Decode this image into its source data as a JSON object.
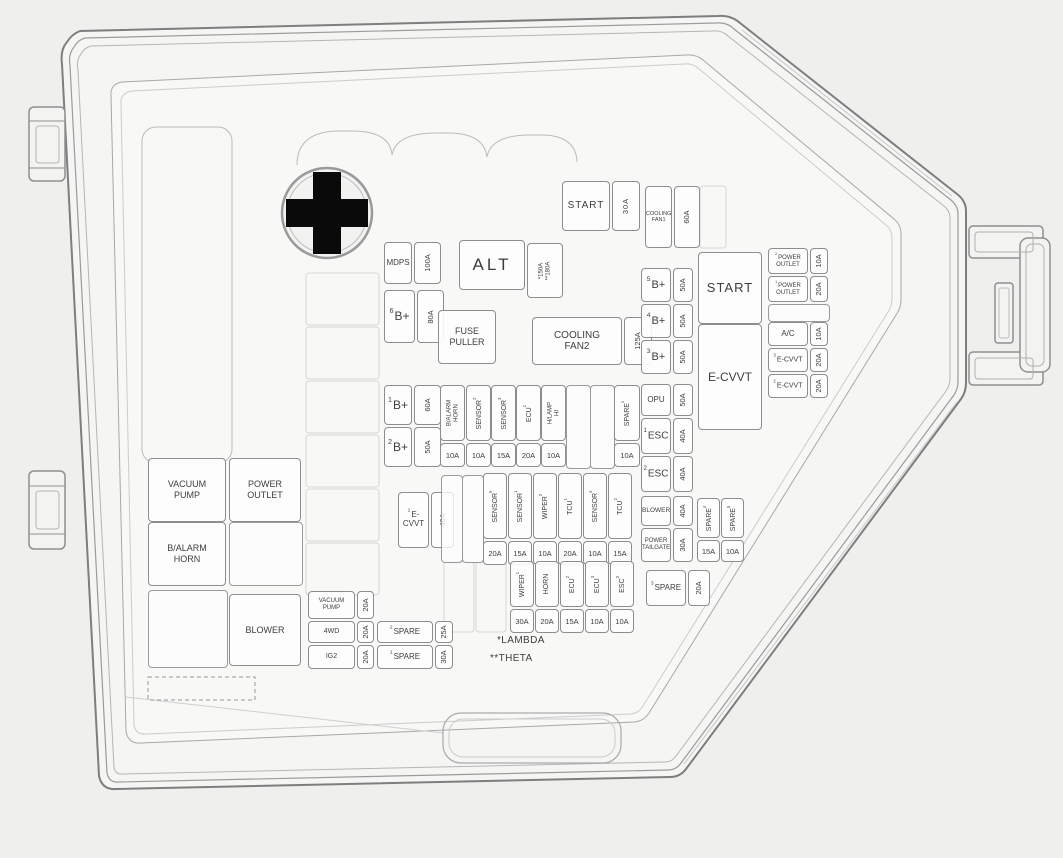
{
  "diagram_title": "Engine compartment fuse box cover diagram",
  "colors": {
    "line": "#8d8d8d",
    "text": "#3e3e3e",
    "background": "#efefee",
    "battery_symbol": "#0a0a0a"
  },
  "notes_legend": {
    "lambda": "*LAMBDA",
    "theta": "**THETA"
  },
  "items": [
    {
      "name": "fuse-start-top",
      "type": "h",
      "label": "START",
      "value": "30A",
      "x": 562,
      "y": 181,
      "w": 78,
      "h": 50,
      "vw": 26,
      "fs": 10,
      "ls": 1
    },
    {
      "name": "fuse-cooling-fan1",
      "type": "h",
      "label": "COOLING",
      "label2": "FAN1",
      "value": "60A",
      "x": 645,
      "y": 186,
      "w": 53,
      "h": 62,
      "vw": 24,
      "fs": 5.5
    },
    {
      "name": "fuse-mdps",
      "type": "h",
      "label": "MDPS",
      "value": "100A",
      "x": 384,
      "y": 242,
      "w": 57,
      "h": 42,
      "vw": 25,
      "fs": 8
    },
    {
      "name": "fuse-b-plus-6",
      "type": "h",
      "sup": "6",
      "label": "B+",
      "value": "80A",
      "x": 384,
      "y": 290,
      "w": 60,
      "h": 53,
      "vw": 25,
      "fs": 12
    },
    {
      "name": "alt-label-box",
      "type": "box",
      "label": "ALT",
      "x": 459,
      "y": 240,
      "w": 66,
      "h": 48,
      "fs": 17,
      "ls": 3
    },
    {
      "name": "fuse-alt",
      "type": "h",
      "label": "",
      "value": "*150A",
      "value2": "**180A",
      "x": 527,
      "y": 243,
      "w": 34,
      "h": 55,
      "vw": 34,
      "vfs": 6
    },
    {
      "name": "fuse-puller-box",
      "type": "box",
      "label": "FUSE",
      "label2": "PULLER",
      "x": 438,
      "y": 310,
      "w": 58,
      "h": 52,
      "fs": 9
    },
    {
      "name": "fuse-b-plus-1",
      "type": "h",
      "sup": "1",
      "label": "B+",
      "value": "60A",
      "x": 384,
      "y": 385,
      "w": 57,
      "h": 40,
      "vw": 25,
      "fs": 12
    },
    {
      "name": "fuse-b-plus-2",
      "type": "h",
      "sup": "2",
      "label": "B+",
      "value": "50A",
      "x": 384,
      "y": 427,
      "w": 57,
      "h": 40,
      "vw": 25,
      "fs": 12
    },
    {
      "name": "fuse-cooling-fan2",
      "type": "h",
      "label": "COOLING",
      "label2": "FAN2",
      "value": "125A",
      "x": 532,
      "y": 317,
      "w": 120,
      "h": 48,
      "vw": 26,
      "fs": 10
    },
    {
      "name": "fuse-e-cvvt-1",
      "type": "h",
      "sup": "1",
      "label": "E-",
      "label2": "CVVT",
      "value": "40A",
      "x": 398,
      "y": 492,
      "w": 56,
      "h": 56,
      "vw": 21,
      "fs": 8
    },
    {
      "name": "fuse-b-alarm-horn",
      "type": "v",
      "label": "B/ALARM",
      "label2": "HORN",
      "value": "10A",
      "x": 440,
      "y": 385,
      "w": 25,
      "h": 82,
      "fs": 6
    },
    {
      "name": "fuse-sensor-2",
      "type": "v",
      "label": "SENSOR",
      "sup": "2",
      "value": "10A",
      "x": 466,
      "y": 385,
      "w": 25,
      "h": 82,
      "fs": 7
    },
    {
      "name": "fuse-sensor-3",
      "type": "v",
      "label": "SENSOR",
      "sup": "3",
      "value": "15A",
      "x": 491,
      "y": 385,
      "w": 25,
      "h": 82,
      "fs": 7
    },
    {
      "name": "fuse-ecu-1",
      "type": "v",
      "label": "ECU",
      "sup": "1",
      "value": "20A",
      "x": 516,
      "y": 385,
      "w": 25,
      "h": 82,
      "fs": 7
    },
    {
      "name": "fuse-h-lamp-hi",
      "type": "v",
      "label": "H/LAMP",
      "label2": "HI",
      "value": "10A",
      "x": 541,
      "y": 385,
      "w": 25,
      "h": 82,
      "fs": 6
    },
    {
      "name": "empty-slot",
      "type": "empty",
      "x": 566,
      "y": 385,
      "w": 23,
      "h": 82
    },
    {
      "name": "empty-slot",
      "type": "empty",
      "x": 590,
      "y": 385,
      "w": 23,
      "h": 82
    },
    {
      "name": "fuse-spare-upper",
      "type": "v",
      "label": "SPARE",
      "sup": "1",
      "value": "10A",
      "x": 614,
      "y": 385,
      "w": 26,
      "h": 82,
      "fs": 7
    },
    {
      "name": "empty-slot",
      "type": "empty",
      "x": 441,
      "y": 475,
      "w": 20,
      "h": 86
    },
    {
      "name": "empty-slot",
      "type": "empty",
      "x": 462,
      "y": 475,
      "w": 20,
      "h": 86
    },
    {
      "name": "fuse-sensor-5",
      "type": "v",
      "label": "SENSOR",
      "sup": "5",
      "value": "20A",
      "x": 483,
      "y": 473,
      "w": 24,
      "h": 92,
      "fs": 7
    },
    {
      "name": "fuse-sensor-1",
      "type": "v",
      "label": "SENSOR",
      "sup": "1",
      "value": "15A",
      "x": 508,
      "y": 473,
      "w": 24,
      "h": 92,
      "fs": 7
    },
    {
      "name": "fuse-wiper-2",
      "type": "v",
      "label": "WIPER",
      "sup": "2",
      "value": "10A",
      "x": 533,
      "y": 473,
      "w": 24,
      "h": 92,
      "fs": 7
    },
    {
      "name": "fuse-tcu-1",
      "type": "v",
      "label": "TCU",
      "sup": "1",
      "value": "20A",
      "x": 558,
      "y": 473,
      "w": 24,
      "h": 92,
      "fs": 7
    },
    {
      "name": "fuse-sensor-4",
      "type": "v",
      "label": "SENSOR",
      "sup": "4",
      "value": "10A",
      "x": 583,
      "y": 473,
      "w": 24,
      "h": 92,
      "fs": 7
    },
    {
      "name": "fuse-tcu-2",
      "type": "v",
      "label": "TCU",
      "sup": "2",
      "value": "15A",
      "x": 608,
      "y": 473,
      "w": 24,
      "h": 92,
      "fs": 7
    },
    {
      "name": "fuse-wiper-1",
      "type": "v",
      "label": "WIPER",
      "sup": "1",
      "value": "30A",
      "x": 510,
      "y": 561,
      "w": 24,
      "h": 72,
      "fs": 7
    },
    {
      "name": "fuse-horn",
      "type": "v",
      "label": "HORN",
      "value": "20A",
      "x": 535,
      "y": 561,
      "w": 24,
      "h": 72,
      "fs": 7
    },
    {
      "name": "fuse-ecu-2",
      "type": "v",
      "label": "ECU",
      "sup": "2",
      "value": "15A",
      "x": 560,
      "y": 561,
      "w": 24,
      "h": 72,
      "fs": 7
    },
    {
      "name": "fuse-ecu-3",
      "type": "v",
      "label": "ECU",
      "sup": "3",
      "value": "10A",
      "x": 585,
      "y": 561,
      "w": 24,
      "h": 72,
      "fs": 7
    },
    {
      "name": "fuse-esc-3",
      "type": "v",
      "label": "ESC",
      "sup": "3",
      "value": "10A",
      "x": 610,
      "y": 561,
      "w": 24,
      "h": 72,
      "fs": 7
    },
    {
      "name": "fuse-spare-3",
      "type": "h",
      "sup": "3",
      "label": "SPARE",
      "value": "20A",
      "x": 646,
      "y": 570,
      "w": 64,
      "h": 36,
      "vw": 20,
      "fs": 8
    },
    {
      "name": "fuse-b-plus-5",
      "type": "h",
      "sup": "5",
      "label": "B+",
      "value": "50A",
      "x": 641,
      "y": 268,
      "w": 52,
      "h": 34,
      "vw": 18,
      "fs": 11
    },
    {
      "name": "fuse-b-plus-4",
      "type": "h",
      "sup": "4",
      "label": "B+",
      "value": "50A",
      "x": 641,
      "y": 304,
      "w": 52,
      "h": 34,
      "vw": 18,
      "fs": 11
    },
    {
      "name": "fuse-b-plus-3",
      "type": "h",
      "sup": "3",
      "label": "B+",
      "value": "50A",
      "x": 641,
      "y": 340,
      "w": 52,
      "h": 34,
      "vw": 18,
      "fs": 11
    },
    {
      "name": "fuse-opu",
      "type": "h",
      "label": "OPU",
      "value": "50A",
      "x": 641,
      "y": 384,
      "w": 52,
      "h": 32,
      "vw": 18,
      "fs": 8
    },
    {
      "name": "fuse-esc-1",
      "type": "h",
      "sup": "1",
      "label": "ESC",
      "value": "40A",
      "x": 641,
      "y": 418,
      "w": 52,
      "h": 36,
      "vw": 18,
      "fs": 10
    },
    {
      "name": "fuse-esc-2",
      "type": "h",
      "sup": "2",
      "label": "ESC",
      "value": "40A",
      "x": 641,
      "y": 456,
      "w": 52,
      "h": 36,
      "vw": 18,
      "fs": 10
    },
    {
      "name": "fuse-blower",
      "type": "h",
      "label": "BLOWER",
      "value": "40A",
      "x": 641,
      "y": 496,
      "w": 52,
      "h": 30,
      "vw": 18,
      "fs": 6.5
    },
    {
      "name": "fuse-power-tailgate",
      "type": "h",
      "label": "POWER",
      "label2": "TAILGATE",
      "value": "30A",
      "x": 641,
      "y": 528,
      "w": 52,
      "h": 34,
      "vw": 18,
      "fs": 6
    },
    {
      "name": "fuse-spare-4",
      "type": "v",
      "label": "SPARE",
      "sup": "4",
      "value": "15A",
      "x": 697,
      "y": 498,
      "w": 23,
      "h": 64,
      "vh": 20,
      "fs": 7
    },
    {
      "name": "fuse-spare-5",
      "type": "v",
      "label": "SPARE",
      "sup": "5",
      "value": "10A",
      "x": 721,
      "y": 498,
      "w": 23,
      "h": 64,
      "vh": 20,
      "fs": 7
    },
    {
      "name": "start-relay-box",
      "type": "box",
      "label": "START",
      "x": 698,
      "y": 252,
      "w": 64,
      "h": 70,
      "fs": 13,
      "ls": 1
    },
    {
      "name": "fuse-power-outlet-2",
      "type": "h",
      "sup": "2",
      "label": "POWER",
      "label2": "OUTLET",
      "value": "10A",
      "x": 768,
      "y": 248,
      "w": 60,
      "h": 26,
      "vw": 16,
      "fs": 6
    },
    {
      "name": "fuse-power-outlet-1",
      "type": "h",
      "sup": "1",
      "label": "POWER",
      "label2": "OUTLET",
      "value": "20A",
      "x": 768,
      "y": 276,
      "w": 60,
      "h": 26,
      "vw": 16,
      "fs": 6
    },
    {
      "name": "empty-slot",
      "type": "empty",
      "x": 768,
      "y": 304,
      "w": 60,
      "h": 16
    },
    {
      "name": "fuse-ac",
      "type": "h",
      "label": "A/C",
      "value": "10A",
      "x": 768,
      "y": 322,
      "w": 60,
      "h": 24,
      "vw": 16,
      "fs": 8
    },
    {
      "name": "e-cvvt-relay-box",
      "type": "box",
      "label": "E-CVVT",
      "x": 698,
      "y": 324,
      "w": 64,
      "h": 104,
      "fs": 12
    },
    {
      "name": "fuse-e-cvvt-3",
      "type": "h",
      "sup": "3",
      "label": "E-CVVT",
      "value": "20A",
      "x": 768,
      "y": 348,
      "w": 60,
      "h": 24,
      "vw": 16,
      "fs": 7
    },
    {
      "name": "fuse-e-cvvt-2",
      "type": "h",
      "sup": "2",
      "label": "E-CVVT",
      "value": "20A",
      "x": 768,
      "y": 374,
      "w": 60,
      "h": 24,
      "vw": 16,
      "fs": 7
    },
    {
      "name": "vacuum-pump-relay-box",
      "type": "box",
      "label": "VACUUM",
      "label2": "PUMP",
      "x": 148,
      "y": 458,
      "w": 78,
      "h": 62,
      "fs": 9
    },
    {
      "name": "power-outlet-relay-box",
      "type": "box",
      "label": "POWER",
      "label2": "OUTLET",
      "x": 229,
      "y": 458,
      "w": 72,
      "h": 62,
      "fs": 9
    },
    {
      "name": "b-alarm-horn-relay-box",
      "type": "box",
      "label": "B/ALARM",
      "label2": "HORN",
      "x": 148,
      "y": 522,
      "w": 78,
      "h": 62,
      "fs": 9
    },
    {
      "name": "empty-slot",
      "type": "empty",
      "x": 229,
      "y": 522,
      "w": 72,
      "h": 62
    },
    {
      "name": "empty-slot",
      "type": "empty",
      "x": 148,
      "y": 590,
      "w": 78,
      "h": 76
    },
    {
      "name": "blower-relay-box",
      "type": "box",
      "label": "BLOWER",
      "x": 229,
      "y": 594,
      "w": 72,
      "h": 70,
      "fs": 9
    },
    {
      "name": "fuse-vacuum-pump",
      "type": "h",
      "label": "VACUUM",
      "label2": "PUMP",
      "value": "20A",
      "x": 308,
      "y": 591,
      "w": 66,
      "h": 28,
      "vw": 15,
      "fs": 6
    },
    {
      "name": "fuse-4wd",
      "type": "h",
      "label": "4WD",
      "value": "20A",
      "x": 308,
      "y": 621,
      "w": 66,
      "h": 22,
      "vw": 15,
      "fs": 7
    },
    {
      "name": "fuse-ig2",
      "type": "h",
      "label": "IG2",
      "value": "20A",
      "x": 308,
      "y": 645,
      "w": 66,
      "h": 24,
      "vw": 15,
      "fs": 7
    },
    {
      "name": "fuse-spare-2",
      "type": "h",
      "sup": "2",
      "label": "SPARE",
      "value": "25A",
      "x": 377,
      "y": 621,
      "w": 76,
      "h": 22,
      "vw": 16,
      "fs": 8
    },
    {
      "name": "fuse-spare-1",
      "type": "h",
      "sup": "1",
      "label": "SPARE",
      "value": "30A",
      "x": 377,
      "y": 645,
      "w": 76,
      "h": 24,
      "vw": 16,
      "fs": 8
    },
    {
      "name": "note-lambda",
      "type": "note",
      "label": "*LAMBDA",
      "x": 497,
      "y": 633,
      "w": 70,
      "h": 14,
      "fs": 10
    },
    {
      "name": "note-theta",
      "type": "note",
      "label": "**THETA",
      "x": 490,
      "y": 651,
      "w": 70,
      "h": 14,
      "fs": 10
    }
  ]
}
